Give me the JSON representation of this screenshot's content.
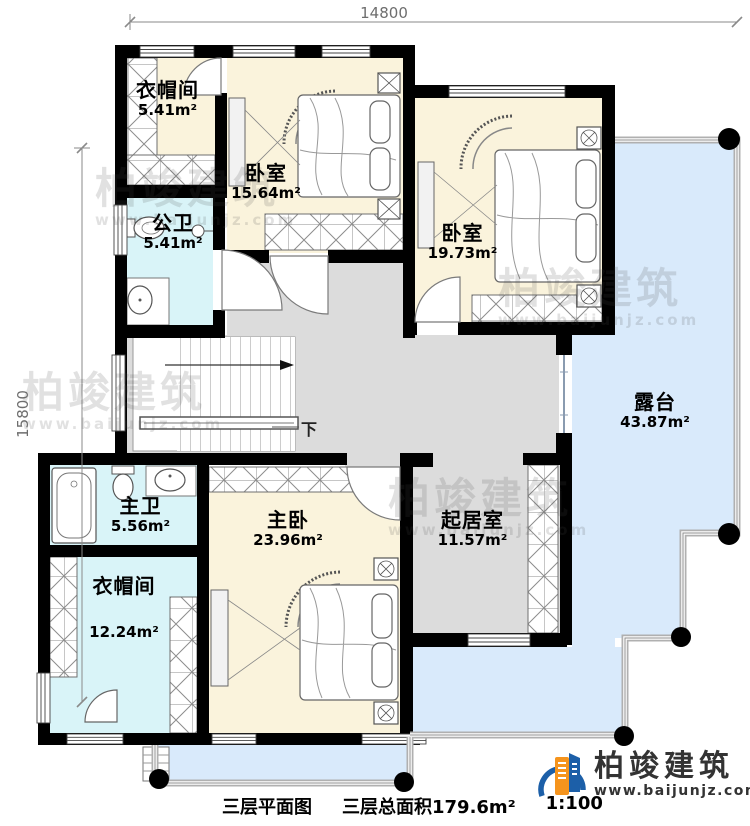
{
  "dimensions": {
    "top": "14800",
    "left": "15800"
  },
  "rooms": {
    "cloak_top": {
      "name": "衣帽间",
      "area": "5.41m²"
    },
    "bedroom_top": {
      "name": "卧室",
      "area": "15.64m²"
    },
    "bedroom_right": {
      "name": "卧室",
      "area": "19.73m²"
    },
    "public_bath": {
      "name": "公卫",
      "area": "5.41m²"
    },
    "terrace": {
      "name": "露台",
      "area": "43.87m²"
    },
    "master_bath": {
      "name": "主卫",
      "area": "5.56m²"
    },
    "master_bedroom": {
      "name": "主卧",
      "area": "23.96m²"
    },
    "cloak_bottom": {
      "name": "衣帽间",
      "area": "12.24m²"
    },
    "living": {
      "name": "起居室",
      "area": "11.57m²"
    }
  },
  "stairs": {
    "down_label": "下"
  },
  "caption": {
    "plan_name": "三层平面图",
    "total_area_label": "三层总面积179.6m²",
    "scale": "1:100"
  },
  "brand": {
    "name": "柏竣建筑",
    "website": "www.baijunjz.com"
  },
  "watermark": {
    "name": "柏竣建筑",
    "website": "www.baijunjz.com"
  },
  "colors": {
    "wall": "#000000",
    "room_cream": "#faf3dc",
    "bath_cyan": "#d9f4f8",
    "terrace_blue": "#d9eafb",
    "hall_gray": "#dcdcdc",
    "brand_blue": "#1c5fa8",
    "brand_orange": "#f5941d"
  }
}
